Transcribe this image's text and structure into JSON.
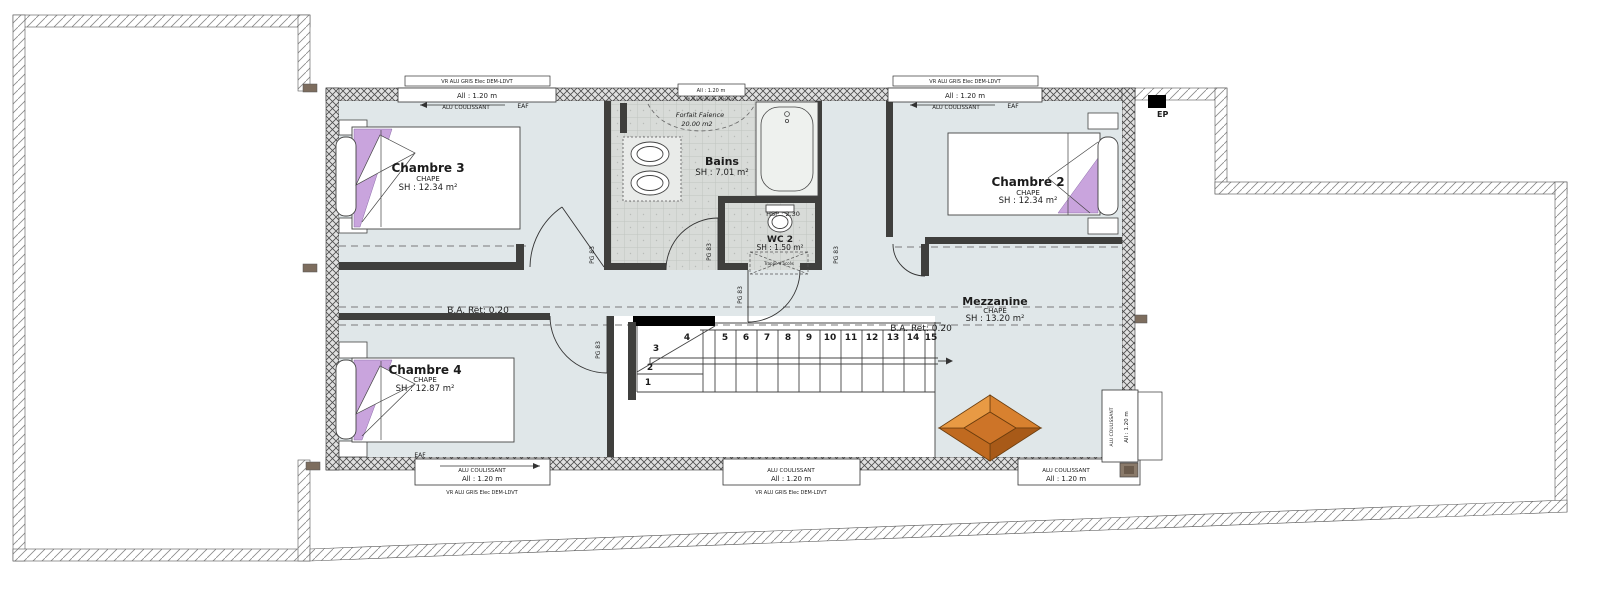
{
  "rooms": {
    "chambre3": {
      "name": "Chambre 3",
      "finish": "CHAPE",
      "area": "SH : 12.34 m²"
    },
    "chambre2": {
      "name": "Chambre 2",
      "finish": "CHAPE",
      "area": "SH : 12.34 m²"
    },
    "chambre4": {
      "name": "Chambre 4",
      "finish": "CHAPE",
      "area": "SH : 12.87 m²"
    },
    "bains": {
      "name": "Bains",
      "area": "SH : 7.01 m²"
    },
    "wc2": {
      "name": "WC 2",
      "area": "SH : 1.50 m²",
      "ceiling_height": "HSP : 2.30",
      "access_hatch": "Trappe d'accès"
    },
    "mezzanine": {
      "name": "Mezzanine",
      "finish": "CHAPE",
      "area": "SH : 13.20 m²"
    }
  },
  "annotations": {
    "faience_note_line1": "Forfait Faïence",
    "faience_note_line2": "20.00 m2",
    "beam_note": "B.A. Ret: 0.20",
    "rainwater_pipe": "EP",
    "air_vent": "EAF",
    "door_label": "PG 83",
    "roller_shutter_label": "VR ALU GRIS Elec DEM-LDVT",
    "window_sill_label": "All : 1.20 m",
    "sliding_window_label": "ALU COULISSANT"
  },
  "stairs": {
    "steps": [
      "1",
      "2",
      "3",
      "4",
      "5",
      "6",
      "7",
      "8",
      "9",
      "10",
      "11",
      "12",
      "13",
      "14",
      "15"
    ]
  },
  "colors": {
    "floor": "#e0e7e9",
    "tile": "#d8dbd8",
    "wall_dark": "#3f3f3d",
    "pillow_purple": "#c9a4dd",
    "skylight_light": "#e89a44",
    "skylight_dark": "#a85a18"
  }
}
